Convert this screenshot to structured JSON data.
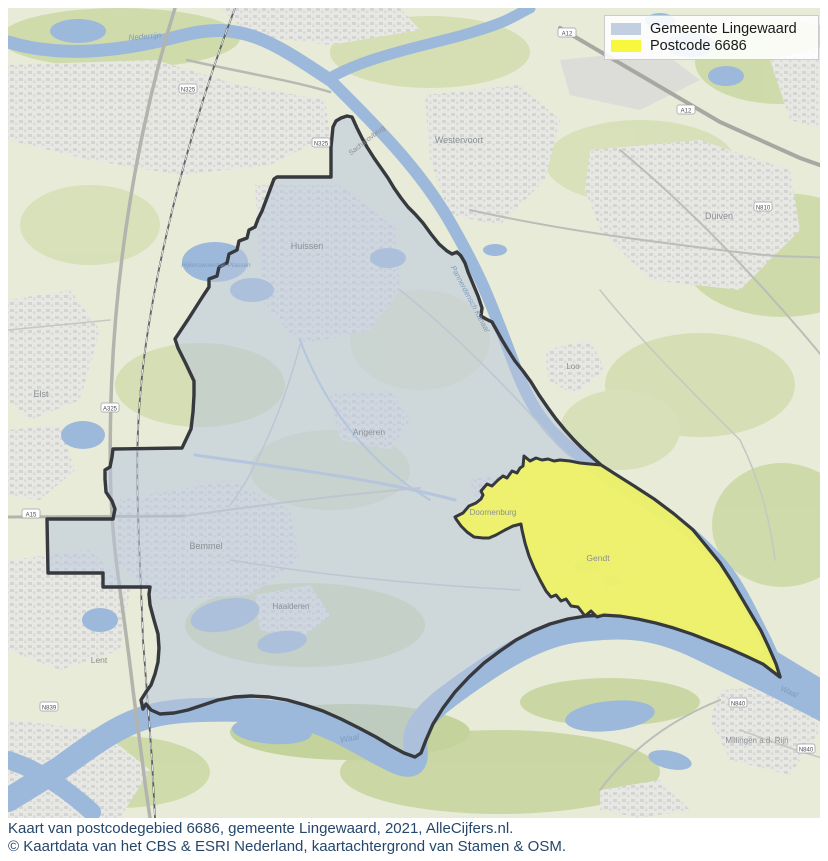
{
  "legend": {
    "items": [
      {
        "label": "Gemeente Lingewaard",
        "color": "#c2cfe0"
      },
      {
        "label": "Postcode 6686",
        "color": "#f7f73e"
      }
    ]
  },
  "map": {
    "colors": {
      "land": "#e7ebd8",
      "green": "#cbd8a3",
      "water": "#9cb8da",
      "urban": "#e7e8e4",
      "municipality_fill": "#b9c6dc",
      "postcode_fill": "#f3f55e",
      "boundary": "#36393d"
    },
    "town_labels": [
      {
        "text": "Westervoort",
        "x": 459,
        "y": 143,
        "size": 9,
        "rot": 0
      },
      {
        "text": "Duiven",
        "x": 719,
        "y": 219,
        "size": 9,
        "rot": 0
      },
      {
        "text": "Huissen",
        "x": 307,
        "y": 249,
        "size": 9,
        "rot": 0
      },
      {
        "text": "Angeren",
        "x": 369,
        "y": 435,
        "size": 8.5,
        "rot": 0
      },
      {
        "text": "Bemmel",
        "x": 206,
        "y": 549,
        "size": 9,
        "rot": 0
      },
      {
        "text": "Haalderen",
        "x": 291,
        "y": 609,
        "size": 8,
        "rot": 0
      },
      {
        "text": "Gendt",
        "x": 598,
        "y": 561,
        "size": 8.5,
        "rot": 0
      },
      {
        "text": "Doornenburg",
        "x": 493,
        "y": 515,
        "size": 8,
        "rot": 0
      },
      {
        "text": "Elst",
        "x": 41,
        "y": 397,
        "size": 9,
        "rot": 0
      },
      {
        "text": "Lent",
        "x": 99,
        "y": 663,
        "size": 8.5,
        "rot": 0
      },
      {
        "text": "Millingen a.d. Rijn",
        "x": 757,
        "y": 743,
        "size": 8,
        "rot": 0
      },
      {
        "text": "Loo",
        "x": 573,
        "y": 369,
        "size": 8,
        "rot": 0
      },
      {
        "text": "Sacharovbrug",
        "x": 368,
        "y": 142,
        "size": 7,
        "rot": -38
      }
    ],
    "water_labels": [
      {
        "text": "Nederrijn",
        "x": 145,
        "y": 39,
        "size": 8,
        "rot": -4
      },
      {
        "text": "Pannerdensch Kanaal",
        "x": 468,
        "y": 300,
        "size": 7.5,
        "rot": 62
      },
      {
        "text": "Waal",
        "x": 350,
        "y": 741,
        "size": 8.5,
        "rot": -10
      },
      {
        "text": "Waal",
        "x": 788,
        "y": 694,
        "size": 8,
        "rot": 25
      },
      {
        "text": "Rijkerswoerdse Plassen",
        "x": 216,
        "y": 267,
        "size": 6.5,
        "rot": 0
      }
    ],
    "road_badges": [
      {
        "text": "A325",
        "x": 110,
        "y": 408
      },
      {
        "text": "A15",
        "x": 31,
        "y": 514
      },
      {
        "text": "A12",
        "x": 567,
        "y": 33
      },
      {
        "text": "A12",
        "x": 686,
        "y": 110
      },
      {
        "text": "N325",
        "x": 188,
        "y": 89
      },
      {
        "text": "N325",
        "x": 321,
        "y": 143
      },
      {
        "text": "N810",
        "x": 763,
        "y": 207
      },
      {
        "text": "N840",
        "x": 738,
        "y": 703
      },
      {
        "text": "N840",
        "x": 806,
        "y": 749
      },
      {
        "text": "N839",
        "x": 49,
        "y": 707
      }
    ]
  },
  "caption": {
    "line1": "Kaart van postcodegebied 6686, gemeente Lingewaard, 2021, AlleCijfers.nl.",
    "line2": "© Kaartdata van het CBS & ESRI Nederland, kaartachtergrond van Stamen & OSM."
  }
}
